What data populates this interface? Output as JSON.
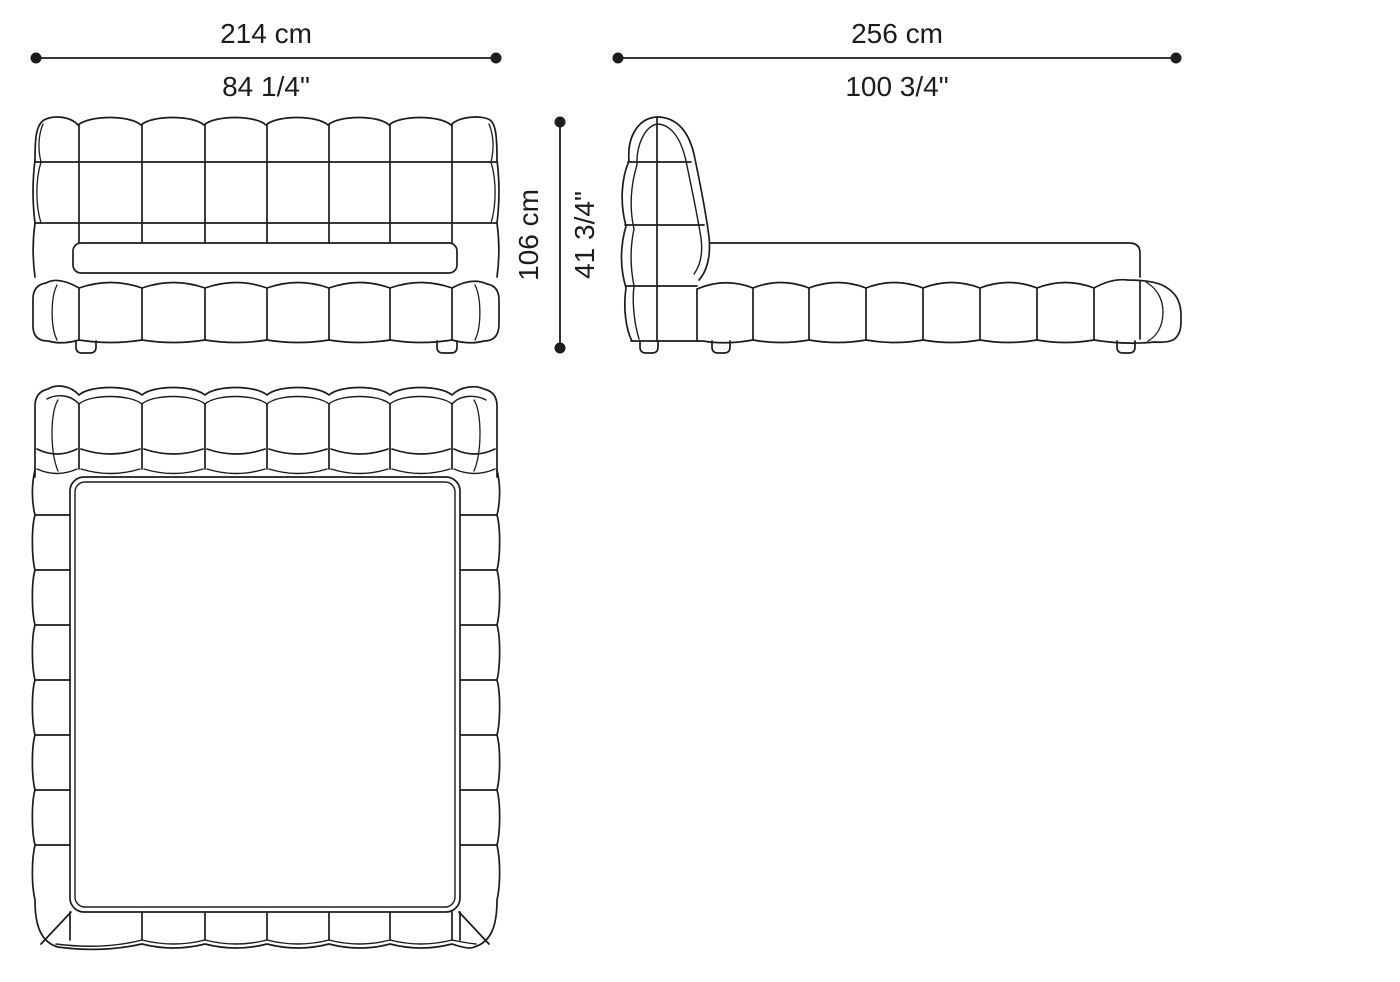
{
  "drawing": {
    "type": "furniture technical drawing - bed, three orthographic views",
    "views": {
      "front": "front elevation",
      "side": "side elevation",
      "top": "plan view"
    }
  },
  "dimensions": {
    "front_width": {
      "cm": "214 cm",
      "inch": "84 1/4\""
    },
    "side_length": {
      "cm": "256 cm",
      "inch": "100 3/4\""
    },
    "height": {
      "cm": "106 cm",
      "inch": "41 3/4\""
    }
  },
  "colors": {
    "line": "#1c1c1c",
    "background": "#ffffff"
  }
}
